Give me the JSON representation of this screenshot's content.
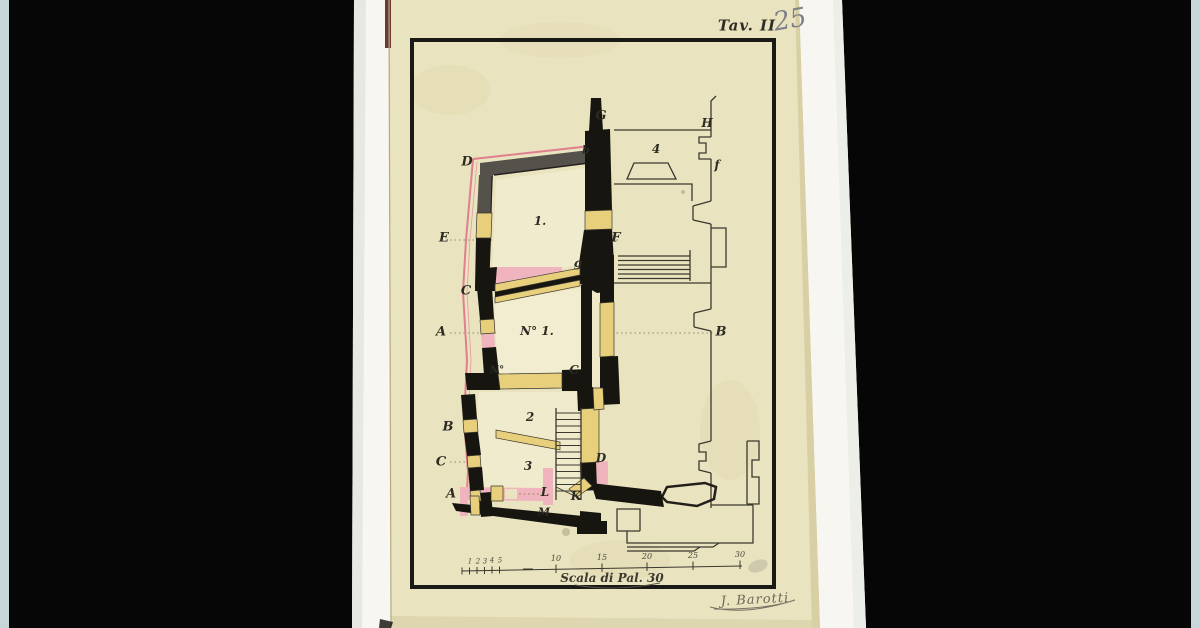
{
  "annotations": {
    "plate_label": "Tav. II",
    "pencil_number": "25",
    "signature": "J. Barotti"
  },
  "plan_labels": [
    {
      "text": "G"
    },
    {
      "text": "H"
    },
    {
      "text": "4"
    },
    {
      "text": "f"
    },
    {
      "text": "D"
    },
    {
      "text": "b"
    },
    {
      "text": "E"
    },
    {
      "text": "1."
    },
    {
      "text": "F"
    },
    {
      "text": "g"
    },
    {
      "text": "C"
    },
    {
      "text": "A"
    },
    {
      "text": "N° 1."
    },
    {
      "text": "B"
    },
    {
      "text": "N°"
    },
    {
      "text": "C"
    },
    {
      "text": "2"
    },
    {
      "text": "B"
    },
    {
      "text": "D"
    },
    {
      "text": "3"
    },
    {
      "text": "C"
    },
    {
      "text": "A"
    },
    {
      "text": "L"
    },
    {
      "text": "K"
    },
    {
      "text": "M"
    }
  ],
  "scale_bar": {
    "caption": "Scala di Pal. 30",
    "minor_numerals": [
      "1",
      "2",
      "3",
      "4",
      "5"
    ],
    "major_numerals": [
      "10",
      "15",
      "20",
      "25",
      "30"
    ]
  },
  "colors": {
    "background": "#000000",
    "edge_strip": "#c6d6d9",
    "backing_sheet": "#f7f6f0",
    "paper": "#eae3bf",
    "ink": "#36342c",
    "wall_black": "#17150f",
    "wall_gray": "#55514b",
    "opening_yellow": "#e7cf7c",
    "wall_pink": "#efb4bd",
    "pink_line": "#e07f8e",
    "pencil": "#7e8088"
  }
}
